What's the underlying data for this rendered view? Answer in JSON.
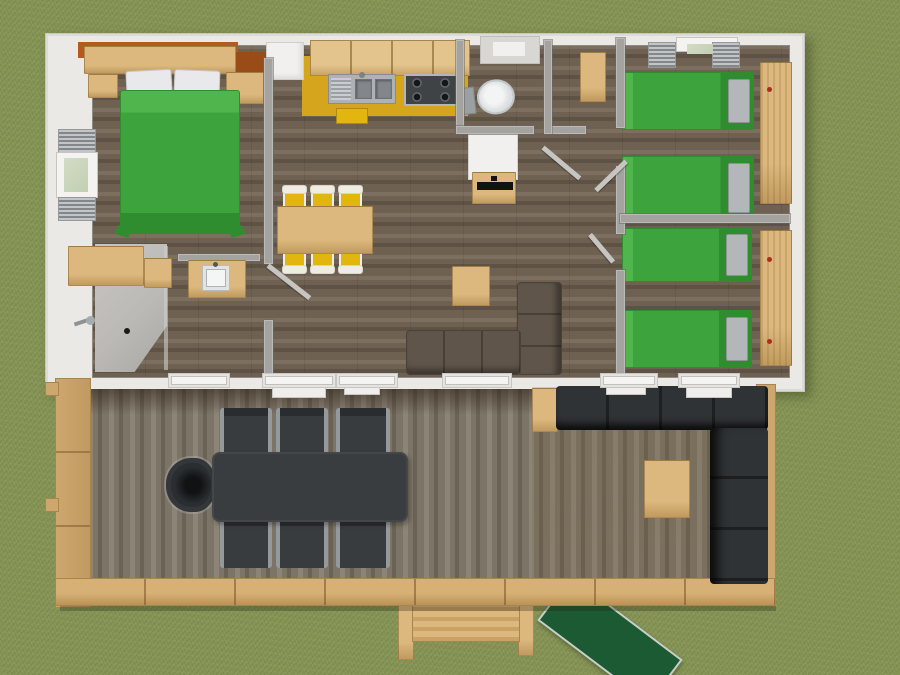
{
  "scene": {
    "type": "3d-floorplan-overhead-render",
    "description": "Top-down 3D rendering of a rectangular cabin / mobile-home with a front wooden deck on a grass lawn",
    "no_visible_text": true
  },
  "colors": {
    "grass": "#839253",
    "grass_dark": "#6f7d43",
    "house_white": "#ebe9e5",
    "wall_gray": "#a5a3a0",
    "wood_floor": "#6f6152",
    "wood_floor_dark": "#5d5244",
    "wood_floor_light": "#7d6f5f",
    "deck_wood": "#7c7466",
    "deck_wood_dark": "#6a6255",
    "deck_wood_light": "#8c8476",
    "railing": "#cda76e",
    "bed_green": "#3da33c",
    "bed_green_dark": "#2f8c2f",
    "bed_green_light": "#4fb54c",
    "pillow_white": "#e9e9ec",
    "pillow_gray": "#b4b7ba",
    "furniture_tan": "#dcb87e",
    "furniture_tan_dark": "#c09a5e",
    "accent_orange": "#b5591c",
    "kitchen_yellow": "#d4a51d",
    "chair_yellow": "#e2b60e",
    "chair_white": "#efece4",
    "stainless": "#aeb2b5",
    "stove_dark": "#3f4345",
    "sofa_taupe": "#5f554a",
    "outdoor_dark": "#303336",
    "outdoor_table": "#3a3d40",
    "outdoor_arm_gray": "#94999c",
    "toilet_white": "#eff0f0",
    "fixture_gray": "#9ba0a3",
    "appliance_white": "#f1f0ee",
    "ramp_green": "#1b5a33",
    "ramp_edge": "#c9cfc9",
    "glass_green": "#c2cfb2",
    "shower_gray": "#bcbab7"
  },
  "house": {
    "rooms": [
      {
        "id": "master-bedroom",
        "items": [
          "double bed with green cover",
          "two white pillows",
          "headboard shelf",
          "orange accent wall",
          "two bedside units",
          "shuttered window on left wall"
        ]
      },
      {
        "id": "bathroom",
        "items": [
          "corner shower with drain",
          "shower head",
          "washbasin cabinet",
          "dresser",
          "small cabinet"
        ]
      },
      {
        "id": "kitchen",
        "items": [
          "yellow counter and splashback",
          "upper cabinets",
          "stainless double sink",
          "4-burner hob",
          "white fridge",
          "roof vent window",
          "yellow stool"
        ]
      },
      {
        "id": "wc",
        "items": [
          "toilet"
        ]
      },
      {
        "id": "living-dining",
        "items": [
          "wooden dining table",
          "six yellow chairs",
          "L-shaped taupe sofa",
          "side table",
          "water-heater cabinet",
          "hall cabinet"
        ]
      },
      {
        "id": "bedroom-2",
        "items": [
          "two green single beds with gray pillows",
          "wardrobe with red handle",
          "shuttered window on top wall"
        ]
      },
      {
        "id": "bedroom-3",
        "items": [
          "two green single beds with gray pillows",
          "shelf unit with red handles",
          "window on bottom wall"
        ]
      }
    ],
    "openings": [
      "5 interior door leaves drawn open",
      "6 white windows and doors along the deck-side wall"
    ]
  },
  "deck": {
    "items": [
      "dark outdoor dining table",
      "six dark chairs with gray armrests",
      "round dark armchair",
      "L-shaped dark corner sofa",
      "wooden side panel",
      "wooden coffee table",
      "tan perimeter railing",
      "wooden entry step",
      "green access ramp on the lawn"
    ]
  },
  "counts": {
    "beds_double": 1,
    "beds_single": 4,
    "dining_chairs": 6,
    "deck_seats": 7,
    "windows_with_shutters": 2
  }
}
